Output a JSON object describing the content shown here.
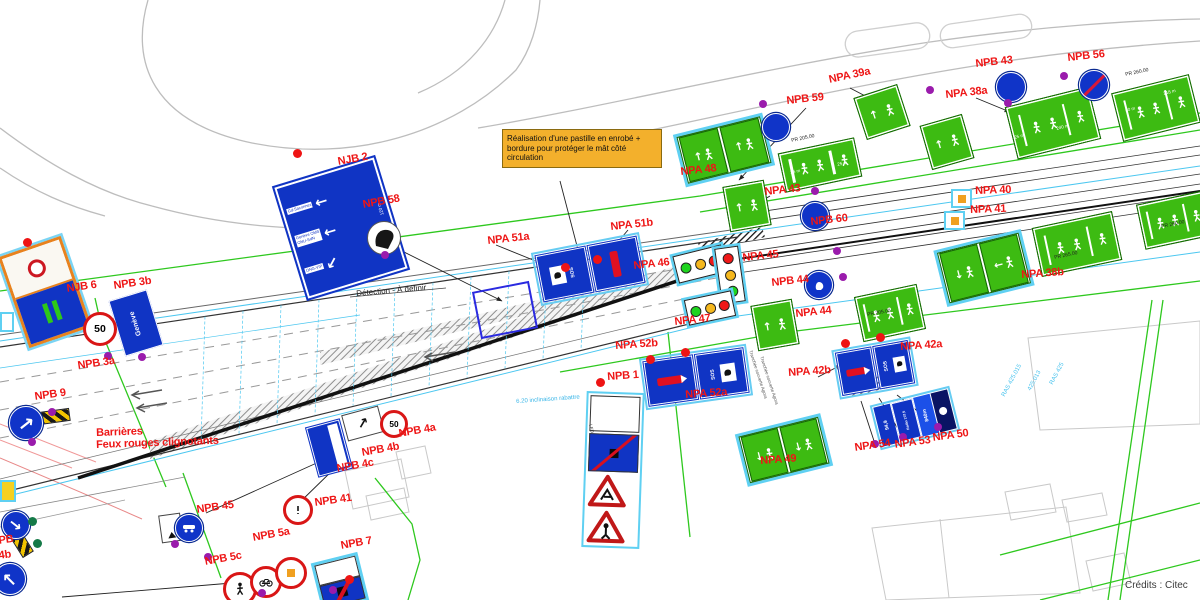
{
  "credits": "Crédits : Citec",
  "note": {
    "text": "Réalisation d'une pastille en enrobé + bordure pour protéger le mât côté circulation"
  },
  "sign_texts": {
    "geneve": "Genève",
    "speed": "50",
    "sos": "SOS",
    "radio1": "94,9",
    "radio2": "Radio 107,5",
    "radio3": "840m",
    "njb2_l1": "Gd-Saconnex",
    "njb2_l2a": "Genève OMS",
    "njb2_l2b": "ONU-SdN",
    "njb2_l3": "ONG-VIP",
    "njb2_dist": "120 m"
  },
  "plan_labels": [
    {
      "t": "NJB 2",
      "x": 337,
      "y": 157,
      "r": -10
    },
    {
      "t": "NPB 58",
      "x": 362,
      "y": 200,
      "r": -10
    },
    {
      "t": "NJB 6",
      "x": 66,
      "y": 284,
      "r": -8
    },
    {
      "t": "NPB 3b",
      "x": 113,
      "y": 281,
      "r": -8
    },
    {
      "t": "NPB 3a",
      "x": 77,
      "y": 361,
      "r": -8
    },
    {
      "t": "NPB 9",
      "x": 34,
      "y": 392,
      "r": -8
    },
    {
      "t": "PB",
      "x": -2,
      "y": 536,
      "r": -8
    },
    {
      "t": "4b",
      "x": -2,
      "y": 551,
      "r": -8
    },
    {
      "t": "NPB 45",
      "x": 196,
      "y": 505,
      "r": -8
    },
    {
      "t": "NPB 41",
      "x": 314,
      "y": 498,
      "r": -8
    },
    {
      "t": "NPB 4a",
      "x": 398,
      "y": 429,
      "r": -10
    },
    {
      "t": "NPB 4b",
      "x": 361,
      "y": 448,
      "r": -10
    },
    {
      "t": "NPB 4c",
      "x": 336,
      "y": 464,
      "r": -10
    },
    {
      "t": "NPB 5a",
      "x": 252,
      "y": 533,
      "r": -10
    },
    {
      "t": "NPB 5c",
      "x": 204,
      "y": 557,
      "r": -10
    },
    {
      "t": "NPB 7",
      "x": 340,
      "y": 541,
      "r": -10
    },
    {
      "t": "NPB 1",
      "x": 607,
      "y": 372,
      "r": -4
    },
    {
      "t": "NPA 52b",
      "x": 615,
      "y": 341,
      "r": -4
    },
    {
      "t": "NPA 52a",
      "x": 685,
      "y": 390,
      "r": -4
    },
    {
      "t": "NPA 51a",
      "x": 487,
      "y": 236,
      "r": -6
    },
    {
      "t": "NPA 51b",
      "x": 610,
      "y": 222,
      "r": -6
    },
    {
      "t": "NPA 46",
      "x": 633,
      "y": 261,
      "r": -6
    },
    {
      "t": "NPA 47",
      "x": 674,
      "y": 317,
      "r": -6
    },
    {
      "t": "NPA 45",
      "x": 742,
      "y": 253,
      "r": -6
    },
    {
      "t": "NPB 44",
      "x": 771,
      "y": 278,
      "r": -6
    },
    {
      "t": "NPA 44",
      "x": 795,
      "y": 309,
      "r": -6
    },
    {
      "t": "NPB 60",
      "x": 810,
      "y": 217,
      "r": -6
    },
    {
      "t": "NPA 43",
      "x": 764,
      "y": 187,
      "r": -6
    },
    {
      "t": "NPA 48",
      "x": 680,
      "y": 167,
      "r": -6
    },
    {
      "t": "NPB 59",
      "x": 786,
      "y": 96,
      "r": -6
    },
    {
      "t": "NPA 39a",
      "x": 828,
      "y": 75,
      "r": -12
    },
    {
      "t": "NPA 38a",
      "x": 945,
      "y": 90,
      "r": -6
    },
    {
      "t": "NPB 43",
      "x": 975,
      "y": 59,
      "r": -6
    },
    {
      "t": "NPB 56",
      "x": 1067,
      "y": 53,
      "r": -6
    },
    {
      "t": "NPA 40",
      "x": 975,
      "y": 186,
      "r": -2
    },
    {
      "t": "NPA 41",
      "x": 970,
      "y": 205,
      "r": -2
    },
    {
      "t": "NPA 38b",
      "x": 1021,
      "y": 270,
      "r": -4
    },
    {
      "t": "NPA 42a",
      "x": 900,
      "y": 342,
      "r": -4
    },
    {
      "t": "NPA 42b",
      "x": 788,
      "y": 368,
      "r": -4
    },
    {
      "t": "NPA 49",
      "x": 760,
      "y": 456,
      "r": -4
    },
    {
      "t": "NPA 54",
      "x": 854,
      "y": 443,
      "r": -8
    },
    {
      "t": "NPA 53",
      "x": 894,
      "y": 440,
      "r": -8
    },
    {
      "t": "NPA 50",
      "x": 932,
      "y": 433,
      "r": -8
    },
    {
      "t": "Barrières",
      "x": 96,
      "y": 428,
      "r": -2
    },
    {
      "t": "Feux rouges clignotants",
      "x": 96,
      "y": 440,
      "r": -2
    }
  ],
  "small_texts": [
    {
      "t": "Détection - À définir",
      "x": 356,
      "y": 290,
      "r": -5,
      "c": "#222",
      "s": 8
    },
    {
      "t": "PR 205.00",
      "x": 791,
      "y": 139,
      "r": -12,
      "c": "#222",
      "s": 5
    },
    {
      "t": "PR 205.00",
      "x": 867,
      "y": 313,
      "r": -10,
      "c": "#222",
      "s": 5
    },
    {
      "t": "PR 260.00",
      "x": 1125,
      "y": 73,
      "r": -12,
      "c": "#222",
      "s": 5
    },
    {
      "t": "PR 260.00",
      "x": 1161,
      "y": 225,
      "r": -12,
      "c": "#222",
      "s": 5
    },
    {
      "t": "PR 265.00",
      "x": 1054,
      "y": 256,
      "r": -12,
      "c": "#222",
      "s": 5
    },
    {
      "t": "240 m",
      "x": 1056,
      "y": 127,
      "r": -14,
      "c": "#fff",
      "s": 4.5
    },
    {
      "t": "25 m",
      "x": 1014,
      "y": 136,
      "r": -14,
      "c": "#fff",
      "s": 4.5
    },
    {
      "t": "80 m",
      "x": 1125,
      "y": 109,
      "r": -14,
      "c": "#fff",
      "s": 4.5
    },
    {
      "t": "218 m",
      "x": 1163,
      "y": 92,
      "r": -14,
      "c": "#fff",
      "s": 4.5
    },
    {
      "t": "35 m",
      "x": 790,
      "y": 171,
      "r": -12,
      "c": "#fff",
      "s": 4.5
    },
    {
      "t": "25 m",
      "x": 837,
      "y": 163,
      "r": -12,
      "c": "#fff",
      "s": 4.5
    },
    {
      "t": "6.20 inclinaison rabattre",
      "x": 516,
      "y": 399,
      "r": -4,
      "c": "#3ab6e8",
      "s": 6
    },
    {
      "t": "RAS 425.015",
      "x": 1001,
      "y": 395,
      "r": -62,
      "c": "#49c3ee",
      "s": 6
    },
    {
      "t": "425.013",
      "x": 1027,
      "y": 389,
      "r": -62,
      "c": "#49c3ee",
      "s": 6
    },
    {
      "t": "RAS 425",
      "x": 1049,
      "y": 383,
      "r": -62,
      "c": "#49c3ee",
      "s": 6
    },
    {
      "t": "Tranchée couverte Agora",
      "x": 752,
      "y": 350,
      "r": 72,
      "c": "#555",
      "s": 4.5
    },
    {
      "t": "Tranchée couverte Agora",
      "x": 763,
      "y": 356,
      "r": 72,
      "c": "#555",
      "s": 4.5
    },
    {
      "t": "LED",
      "x": 592,
      "y": 424,
      "r": 78,
      "c": "#333",
      "s": 4.5
    }
  ],
  "green_signs": [
    {
      "x": 859,
      "y": 90,
      "w": 40,
      "h": 38,
      "r": -18,
      "v": "single"
    },
    {
      "x": 681,
      "y": 126,
      "w": 82,
      "h": 44,
      "r": -14,
      "v": "double-up"
    },
    {
      "x": 781,
      "y": 145,
      "w": 72,
      "h": 34,
      "r": -12,
      "v": "wide"
    },
    {
      "x": 726,
      "y": 183,
      "w": 36,
      "h": 40,
      "r": -10,
      "v": "single"
    },
    {
      "x": 754,
      "y": 302,
      "w": 36,
      "h": 40,
      "r": -10,
      "v": "single"
    },
    {
      "x": 858,
      "y": 290,
      "w": 58,
      "h": 40,
      "r": -12,
      "v": "wide"
    },
    {
      "x": 1010,
      "y": 96,
      "w": 80,
      "h": 48,
      "r": -14,
      "v": "wide"
    },
    {
      "x": 1116,
      "y": 83,
      "w": 74,
      "h": 44,
      "r": -14,
      "v": "wide"
    },
    {
      "x": 942,
      "y": 242,
      "w": 80,
      "h": 48,
      "r": -14,
      "v": "double-left"
    },
    {
      "x": 1036,
      "y": 219,
      "w": 76,
      "h": 44,
      "r": -12,
      "v": "wide"
    },
    {
      "x": 1140,
      "y": 197,
      "w": 64,
      "h": 40,
      "r": -12,
      "v": "wide"
    },
    {
      "x": 743,
      "y": 426,
      "w": 78,
      "h": 44,
      "r": -14,
      "v": "double-down"
    },
    {
      "x": 925,
      "y": 119,
      "w": 38,
      "h": 40,
      "r": -16,
      "v": "single"
    }
  ],
  "signals": [
    {
      "x": 675,
      "y": 250,
      "w": 48,
      "h": 26,
      "r": -14,
      "o": "h",
      "lights": [
        "g",
        "y",
        "r"
      ]
    },
    {
      "x": 718,
      "y": 247,
      "w": 22,
      "h": 54,
      "r": -8,
      "o": "v",
      "lights": [
        "r",
        "y",
        "g"
      ]
    },
    {
      "x": 686,
      "y": 295,
      "w": 46,
      "h": 24,
      "r": -12,
      "o": "h",
      "lights": [
        "g",
        "y",
        "r"
      ]
    }
  ],
  "blue_circles": [
    {
      "x": 775,
      "y": 126,
      "r": 13,
      "g": "",
      "slash": false
    },
    {
      "x": 814,
      "y": 215,
      "r": 13,
      "g": "",
      "slash": false
    },
    {
      "x": 1010,
      "y": 86,
      "r": 14,
      "g": "",
      "slash": false
    },
    {
      "x": 1093,
      "y": 84,
      "r": 14,
      "g": "",
      "slash": true
    },
    {
      "x": 818,
      "y": 284,
      "r": 13,
      "g": "hand",
      "slash": false
    },
    {
      "x": 188,
      "y": 527,
      "r": 13,
      "g": "car",
      "slash": false
    }
  ],
  "arrow_circles": [
    {
      "x": 25,
      "y": 422,
      "r": 16,
      "rot": -38
    },
    {
      "x": 15,
      "y": 524,
      "r": 13,
      "rot": 38
    },
    {
      "x": 9,
      "y": 578,
      "r": 15,
      "rot": -135
    }
  ],
  "red_circles": [
    {
      "x": 97,
      "y": 326,
      "r": 14,
      "k": "50"
    },
    {
      "x": 391,
      "y": 421,
      "r": 11,
      "k": "50"
    },
    {
      "x": 295,
      "y": 507,
      "r": 12,
      "k": "mark"
    },
    {
      "x": 237,
      "y": 586,
      "r": 14,
      "k": "ped"
    },
    {
      "x": 263,
      "y": 579,
      "r": 13,
      "k": "bike"
    },
    {
      "x": 288,
      "y": 570,
      "r": 13,
      "k": "square"
    }
  ],
  "stripe_bars": [
    {
      "x": 38,
      "y": 410,
      "w": 30,
      "h": 11,
      "r": -8
    },
    {
      "x": 10,
      "y": 538,
      "w": 22,
      "h": 11,
      "r": 58
    }
  ],
  "orange_boxes": [
    {
      "x": 951,
      "y": 189
    },
    {
      "x": 944,
      "y": 211
    }
  ],
  "mini_signs": [
    {
      "x": 0,
      "y": 480,
      "w": 12,
      "h": 18,
      "y_fill": true
    },
    {
      "x": 0,
      "y": 312,
      "w": 10,
      "h": 16,
      "y_fill": false
    }
  ],
  "dots": {
    "purple": [
      [
        385,
        255
      ],
      [
        763,
        104
      ],
      [
        930,
        90
      ],
      [
        1008,
        103
      ],
      [
        1064,
        76
      ],
      [
        815,
        191
      ],
      [
        837,
        251
      ],
      [
        843,
        277
      ],
      [
        108,
        356
      ],
      [
        142,
        357
      ],
      [
        52,
        412
      ],
      [
        32,
        442
      ],
      [
        175,
        544
      ],
      [
        208,
        557
      ],
      [
        262,
        593
      ],
      [
        333,
        590
      ],
      [
        875,
        444
      ],
      [
        903,
        437
      ],
      [
        938,
        427
      ]
    ],
    "red": [
      [
        297,
        153
      ],
      [
        27,
        242
      ],
      [
        565,
        267
      ],
      [
        597,
        259
      ],
      [
        600,
        382
      ],
      [
        650,
        359
      ],
      [
        685,
        352
      ],
      [
        845,
        343
      ],
      [
        880,
        337
      ],
      [
        349,
        579
      ]
    ],
    "green": [
      [
        32,
        521
      ],
      [
        37,
        543
      ]
    ]
  }
}
